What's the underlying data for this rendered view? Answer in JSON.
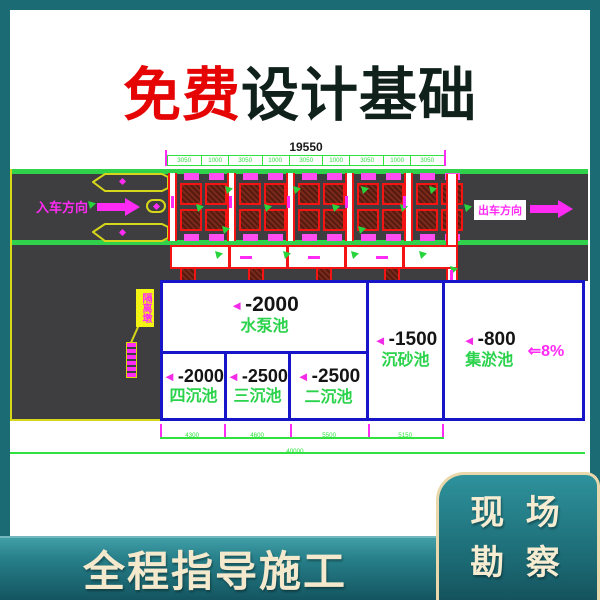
{
  "headline": {
    "free": "免费",
    "rest": "设计基础"
  },
  "drawing": {
    "dim_total_top": "19550",
    "dims_top": [
      "3050",
      "1000",
      "3050",
      "1000",
      "3050",
      "1000",
      "3050",
      "1000",
      "3050"
    ],
    "in_direction": "入车方向",
    "out_direction": "出车方向",
    "island_tag": "隔离墩",
    "pool_marker": "◄",
    "pools": {
      "pump": {
        "depth": "-2000",
        "name": "水泵池"
      },
      "fourth": {
        "depth": "-2000",
        "name": "四沉池"
      },
      "third": {
        "depth": "-2500",
        "name": "三沉池"
      },
      "second": {
        "depth": "-2500",
        "name": "二沉池"
      },
      "grit": {
        "depth": "-1500",
        "name": "沉砂池"
      },
      "silt": {
        "depth": "-800",
        "name": "集淤池"
      }
    },
    "slope": "⇐8%",
    "dims_bottom": [
      "4300",
      "4600",
      "5500",
      "5150"
    ],
    "dim_total_bottom": "40000"
  },
  "footer": {
    "guide": "全程指导施工",
    "badge_line1": "现 场",
    "badge_line2": "勘 察"
  }
}
